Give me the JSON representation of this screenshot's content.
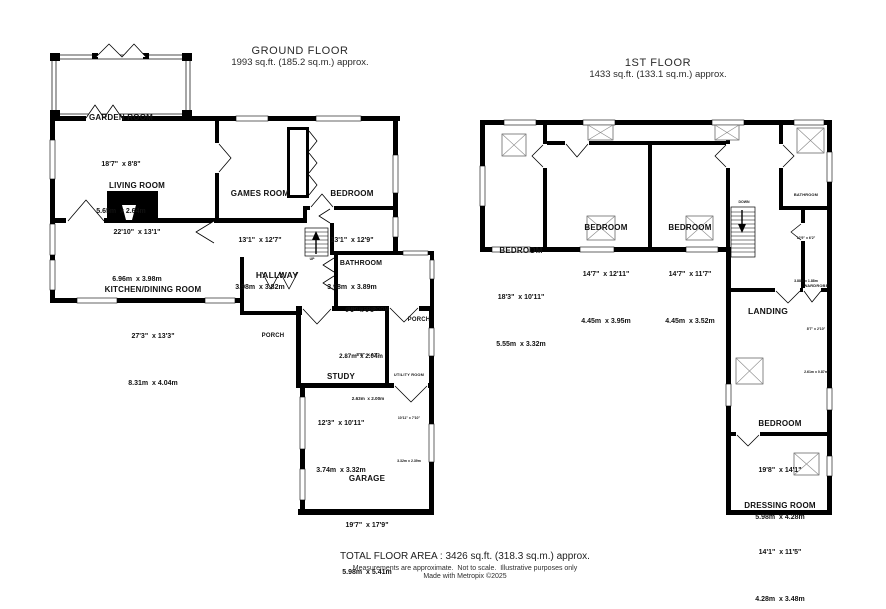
{
  "floors": [
    {
      "title": "GROUND FLOOR",
      "subtitle": "1993 sq.ft. (185.2 sq.m.) approx.",
      "stairs_label": "UP",
      "rooms": [
        {
          "name": "GARDEN ROOM",
          "imperial": "18'7\"  x 8'8\"",
          "metric": "5.65m  x 2.64m"
        },
        {
          "name": "LIVING ROOM",
          "imperial": "22'10\"  x 13'1\"",
          "metric": "6.96m  x 3.98m"
        },
        {
          "name": "GAMES ROOM",
          "imperial": "13'1\"  x 12'7\"",
          "metric": "3.98m  x 3.82m"
        },
        {
          "name": "BEDROOM",
          "imperial": "13'1\"  x 12'9\"",
          "metric": "3.98m  x 3.89m"
        },
        {
          "name": "KITCHEN/DINING ROOM",
          "imperial": "27'3\"  x 13'3\"",
          "metric": "8.31m  x 4.04m"
        },
        {
          "name": "HALLWAY"
        },
        {
          "name": "BATHROOM",
          "imperial": "9'5\"  x 6'8\"",
          "metric": "2.87m  x 2.04m"
        },
        {
          "name": "SHOWER ROOM",
          "imperial": "8'8\"  x 6'7\"",
          "metric": "2.63m  x 2.00m"
        },
        {
          "name": "PORCH"
        },
        {
          "name": "PORCH"
        },
        {
          "name": "STUDY",
          "imperial": "12'3\"  x 10'11\"",
          "metric": "3.74m  x 3.32m"
        },
        {
          "name": "UTILITY ROOM",
          "imperial": "10'11\" x 7'10\"",
          "metric": "3.32m x 2.39m"
        },
        {
          "name": "GARAGE",
          "imperial": "19'7\"  x 17'9\"",
          "metric": "5.98m  x 5.41m"
        }
      ]
    },
    {
      "title": "1ST FLOOR",
      "subtitle": "1433 sq.ft. (133.1 sq.m.) approx.",
      "stairs_label": "DOWN",
      "rooms": [
        {
          "name": "BEDROOM",
          "imperial": "18'3\"  x 10'11\"",
          "metric": "5.55m  x 3.32m"
        },
        {
          "name": "BEDROOM",
          "imperial": "14'7\"  x 12'11\"",
          "metric": "4.45m  x 3.95m"
        },
        {
          "name": "BEDROOM",
          "imperial": "14'7\"  x 11'7\"",
          "metric": "4.45m  x 3.52m"
        },
        {
          "name": "BATHROOM",
          "imperial": "12'9\" x 6'2\"",
          "metric": "3.88m x 1.88m"
        },
        {
          "name": "LANDING"
        },
        {
          "name": "WARDROBE",
          "imperial": "8'7\" x 2'10\"",
          "metric": "2.61m x 0.87m"
        },
        {
          "name": "BEDROOM",
          "imperial": "19'8\"  x 14'1\"",
          "metric": "5.98m  x 4.28m"
        },
        {
          "name": "DRESSING ROOM",
          "imperial": "14'1\"  x 11'5\"",
          "metric": "4.28m  x 3.48m"
        }
      ]
    }
  ],
  "footer": {
    "total": "TOTAL FLOOR AREA : 3426 sq.ft. (318.3 sq.m.) approx.",
    "disclaimer": "Measurements are approximate.  Not to scale.  Illustrative purposes only",
    "credit": "Made with Metropix ©2025"
  }
}
